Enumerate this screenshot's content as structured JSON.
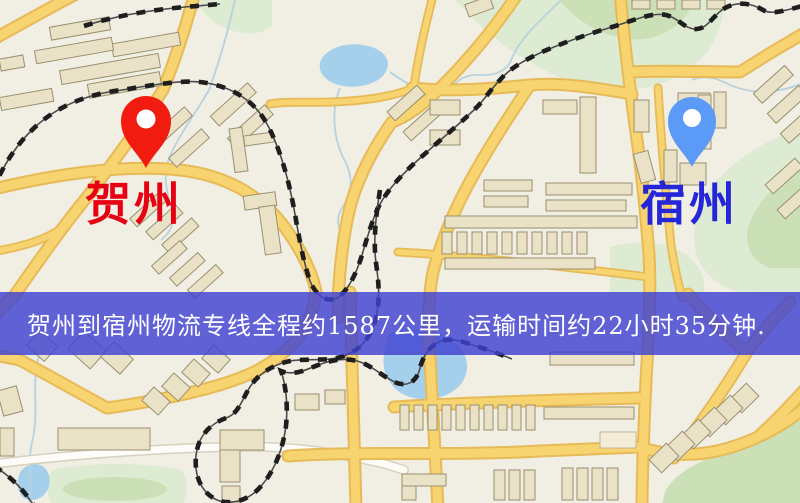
{
  "route_map": {
    "origin": {
      "label": "贺州",
      "pin_color": "#f11b10",
      "label_color": "#e60012"
    },
    "destination": {
      "label": "宿州",
      "pin_color": "#5b9af6",
      "label_color": "#2626d9"
    },
    "banner": {
      "text": "贺州到宿州物流专线全程约1587公里，运输时间约22小时35分钟.",
      "background_color": "#4042d2",
      "text_color": "#ffffff",
      "distance_km": "1587",
      "duration": "22小时35分钟"
    },
    "map_colors": {
      "land": "#f1eee4",
      "road": "#f7d470",
      "road_casing": "#e7ba58",
      "water": "#a4d0ec",
      "park": "#dcebd2",
      "building": "#eae2c6",
      "railway": "#1e1e1e"
    }
  }
}
